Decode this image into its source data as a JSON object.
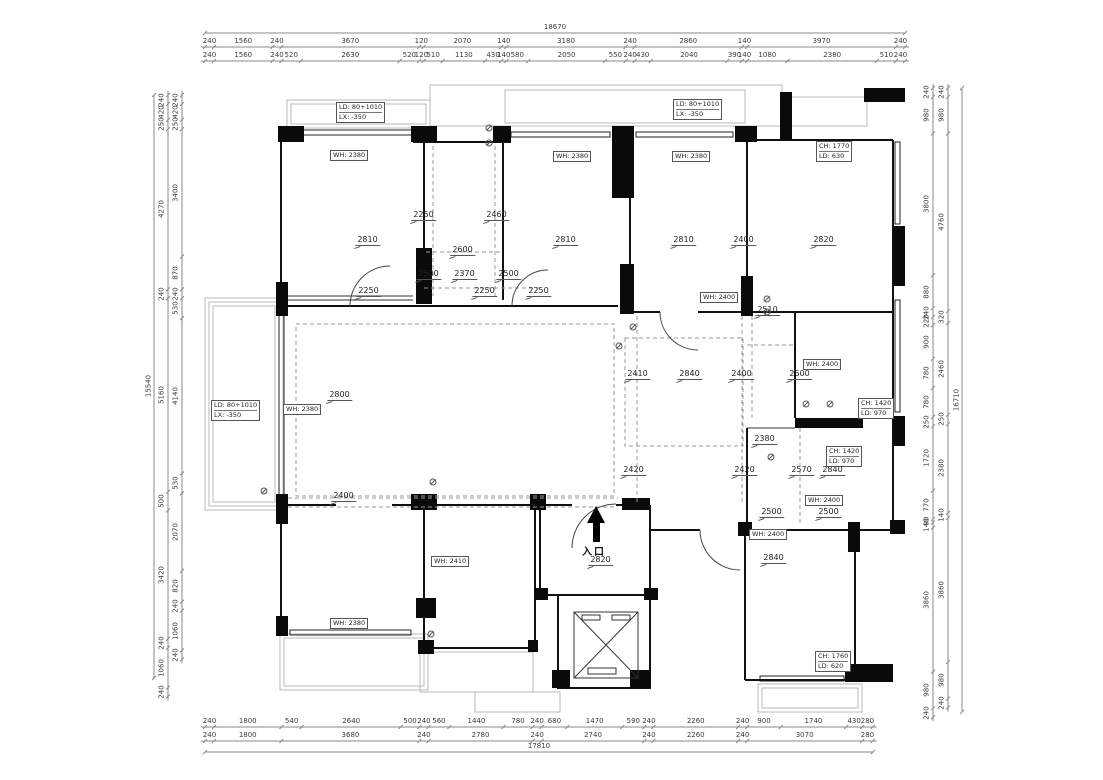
{
  "meta": {
    "drawing_type": "floor-plan",
    "language": "zh-CN",
    "bg_color": "#ffffff",
    "line_color": "#111111",
    "dim_color": "#3a3a3a"
  },
  "dimensions": {
    "top": {
      "overall": "18670",
      "row1": [
        "240",
        "1560",
        "240",
        "3670",
        "120",
        "2070",
        "140",
        "3180",
        "240",
        "2860",
        "140",
        "3970",
        "240"
      ],
      "row2": [
        "240",
        "1560",
        "240",
        "520",
        "2630",
        "520",
        "120",
        "510",
        "1130",
        "430",
        "140",
        "580",
        "2050",
        "550",
        "240",
        "430",
        "2040",
        "390",
        "140",
        "1080",
        "2380",
        "510",
        "240"
      ]
    },
    "bottom": {
      "row1": [
        "240",
        "1800",
        "540",
        "2640",
        "500",
        "240",
        "560",
        "1440",
        "780",
        "240",
        "680",
        "1470",
        "590",
        "240",
        "2260",
        "240",
        "900",
        "1740",
        "430",
        "280"
      ],
      "row2": [
        "240",
        "1800",
        "3680",
        "240",
        "2780",
        "240",
        "2740",
        "240",
        "2260",
        "240",
        "3070",
        "280"
      ],
      "overall": "17810"
    },
    "left": {
      "overall": "15540",
      "outer": [
        "240",
        "420",
        "250",
        "4270",
        "240",
        "5160",
        "500",
        "3420",
        "240",
        "1060",
        "240"
      ],
      "inner": [
        "240",
        "420",
        "250",
        "3400",
        "870",
        "240",
        "530",
        "4140",
        "530",
        "2070",
        "820",
        "240",
        "1060",
        "240"
      ]
    },
    "right": {
      "inner": [
        "240",
        "980",
        "3800",
        "880",
        "240",
        "220",
        "900",
        "780",
        "780",
        "250",
        "1720",
        "770",
        "90",
        "140",
        "3860",
        "980",
        "240"
      ],
      "outer": [
        "240",
        "980",
        "4760",
        "320",
        "2460",
        "250",
        "2380",
        "140",
        "3860",
        "980",
        "240"
      ],
      "overall": "16710"
    }
  },
  "entrance": {
    "label": "入口",
    "level": "2820",
    "icon": "up-arrow-icon"
  },
  "levels": [
    {
      "v": "2810",
      "x": 368,
      "y": 246
    },
    {
      "v": "2810",
      "x": 566,
      "y": 246
    },
    {
      "v": "2810",
      "x": 684,
      "y": 246
    },
    {
      "v": "2400",
      "x": 744,
      "y": 246
    },
    {
      "v": "2820",
      "x": 824,
      "y": 246
    },
    {
      "v": "2250",
      "x": 424,
      "y": 221
    },
    {
      "v": "2460",
      "x": 497,
      "y": 221
    },
    {
      "v": "2600",
      "x": 463,
      "y": 256
    },
    {
      "v": "2500",
      "x": 429,
      "y": 280
    },
    {
      "v": "2370",
      "x": 465,
      "y": 280
    },
    {
      "v": "2500",
      "x": 509,
      "y": 280
    },
    {
      "v": "2250",
      "x": 369,
      "y": 297
    },
    {
      "v": "2250",
      "x": 485,
      "y": 297
    },
    {
      "v": "2250",
      "x": 539,
      "y": 297
    },
    {
      "v": "2510",
      "x": 768,
      "y": 316
    },
    {
      "v": "2800",
      "x": 340,
      "y": 401
    },
    {
      "v": "2410",
      "x": 638,
      "y": 380
    },
    {
      "v": "2840",
      "x": 690,
      "y": 380
    },
    {
      "v": "2400",
      "x": 742,
      "y": 380
    },
    {
      "v": "2600",
      "x": 800,
      "y": 380
    },
    {
      "v": "2380",
      "x": 765,
      "y": 445
    },
    {
      "v": "2420",
      "x": 634,
      "y": 476
    },
    {
      "v": "2420",
      "x": 745,
      "y": 476
    },
    {
      "v": "2570",
      "x": 802,
      "y": 476
    },
    {
      "v": "2840",
      "x": 833,
      "y": 476
    },
    {
      "v": "2400",
      "x": 344,
      "y": 502
    },
    {
      "v": "2500",
      "x": 772,
      "y": 518
    },
    {
      "v": "2500",
      "x": 829,
      "y": 518
    },
    {
      "v": "2820",
      "x": 601,
      "y": 566
    },
    {
      "v": "2840",
      "x": 774,
      "y": 564
    }
  ],
  "boxes": [
    {
      "lines": [
        "LD: 80+1010",
        "LX: -350"
      ],
      "x": 336,
      "y": 102
    },
    {
      "lines": [
        "LD: 80+1010",
        "LX: -350"
      ],
      "x": 673,
      "y": 99
    },
    {
      "lines": [
        "CH: 1770",
        "LD: 630"
      ],
      "x": 816,
      "y": 141
    },
    {
      "lines": [
        "WH: 2380"
      ],
      "x": 330,
      "y": 150
    },
    {
      "lines": [
        "WH: 2380"
      ],
      "x": 553,
      "y": 151
    },
    {
      "lines": [
        "WH: 2380"
      ],
      "x": 672,
      "y": 151
    },
    {
      "lines": [
        "WH: 2400"
      ],
      "x": 700,
      "y": 292
    },
    {
      "lines": [
        "LD: 80+1010",
        "LX: -350"
      ],
      "x": 211,
      "y": 400
    },
    {
      "lines": [
        "WH: 2380"
      ],
      "x": 283,
      "y": 404
    },
    {
      "lines": [
        "WH: 2400"
      ],
      "x": 803,
      "y": 359
    },
    {
      "lines": [
        "CH: 1420",
        "LD: 970"
      ],
      "x": 858,
      "y": 398
    },
    {
      "lines": [
        "CH: 1420",
        "LD: 970"
      ],
      "x": 826,
      "y": 446
    },
    {
      "lines": [
        "WH: 2400"
      ],
      "x": 805,
      "y": 495
    },
    {
      "lines": [
        "WH: 2400"
      ],
      "x": 749,
      "y": 529
    },
    {
      "lines": [
        "WH: 2410"
      ],
      "x": 431,
      "y": 556
    },
    {
      "lines": [
        "WH: 2380"
      ],
      "x": 330,
      "y": 618
    },
    {
      "lines": [
        "CH: 1760",
        "LD: 620"
      ],
      "x": 815,
      "y": 651
    }
  ],
  "symbols": [
    {
      "name": "switch-icon",
      "x": 489,
      "y": 128
    },
    {
      "name": "switch-icon",
      "x": 489,
      "y": 143
    },
    {
      "name": "switch-icon",
      "x": 619,
      "y": 346
    },
    {
      "name": "switch-icon",
      "x": 633,
      "y": 327
    },
    {
      "name": "switch-icon",
      "x": 767,
      "y": 299
    },
    {
      "name": "switch-icon",
      "x": 767,
      "y": 312
    },
    {
      "name": "switch-icon",
      "x": 806,
      "y": 404
    },
    {
      "name": "switch-icon",
      "x": 830,
      "y": 404
    },
    {
      "name": "switch-icon",
      "x": 264,
      "y": 491
    },
    {
      "name": "switch-icon",
      "x": 433,
      "y": 482
    },
    {
      "name": "switch-icon",
      "x": 771,
      "y": 457
    },
    {
      "name": "switch-icon",
      "x": 431,
      "y": 634
    }
  ]
}
